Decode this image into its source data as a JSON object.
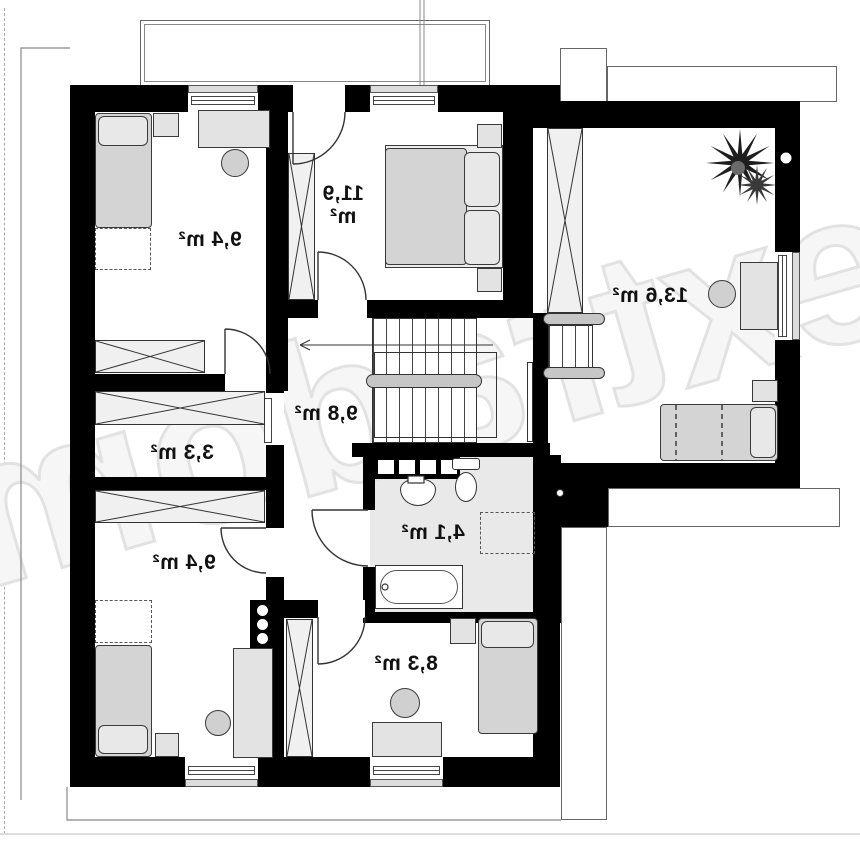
{
  "plan": {
    "watermark": "extradom",
    "rooms": [
      {
        "id": "bedroom-top-left",
        "area": "9,4 m²"
      },
      {
        "id": "bedroom-top-middle",
        "area": "11,9 m²"
      },
      {
        "id": "room-top-right",
        "area": "13,6 m²"
      },
      {
        "id": "hallway",
        "area": "9,8 m²"
      },
      {
        "id": "closet",
        "area": "3,3 m²"
      },
      {
        "id": "bathroom",
        "area": "4,1 m²"
      },
      {
        "id": "bedroom-bottom-middle",
        "area": "8,3 m²"
      },
      {
        "id": "bedroom-bottom-left",
        "area": "9,4 m²"
      }
    ],
    "colors": {
      "wall": "#000000",
      "floor": "#ffffff",
      "bathroom_floor": "#e9e9e9",
      "furniture": "#e3e3e3",
      "hatch_fill": "#f0f0f0",
      "watermark": "#e2e2e2"
    }
  }
}
